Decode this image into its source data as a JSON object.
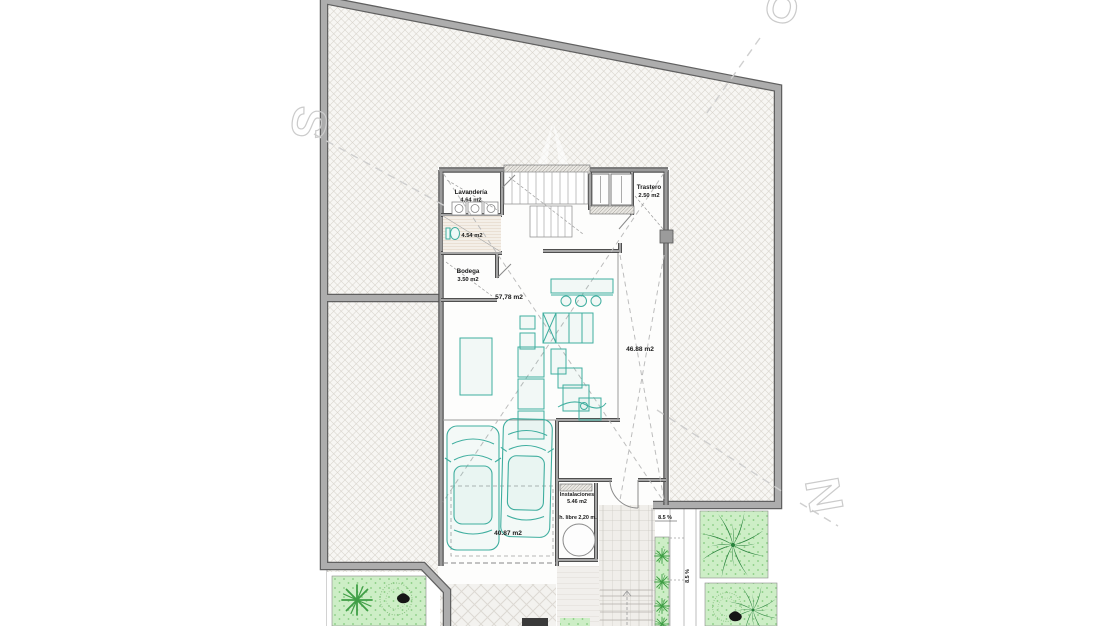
{
  "plan": {
    "rooms": {
      "lavanderia": {
        "name": "Lavandería",
        "area": "4.64 m2"
      },
      "aseo": {
        "area": "4.54 m2"
      },
      "bodega": {
        "name": "Bodega",
        "area": "3.50 m2"
      },
      "trastero": {
        "name": "Trastero",
        "area": "2.50 m2"
      },
      "salon": {
        "area": "57,78 m2"
      },
      "zona_derecha": {
        "area": "46.88 m2"
      },
      "garaje": {
        "area": "40.87 m2"
      },
      "instalaciones": {
        "name": "Instalaciones",
        "area": "5.46 m2"
      },
      "altura_libre": {
        "label": "h. libre 2,20 m."
      }
    },
    "annotations": {
      "ramp_slope": "8.5 %",
      "ramp_slope_side": "8.5 %"
    },
    "watermark": {
      "letter_s": "S",
      "letter_o": "O",
      "letter_n": "N"
    },
    "colors": {
      "wall": "#9e9e9e",
      "wall_dark": "#606060",
      "hatch_line": "#d8d4cc",
      "furniture_teal": "#3fae9f",
      "grass": "#cdeec6",
      "palm_green": "#1c7a32"
    }
  }
}
